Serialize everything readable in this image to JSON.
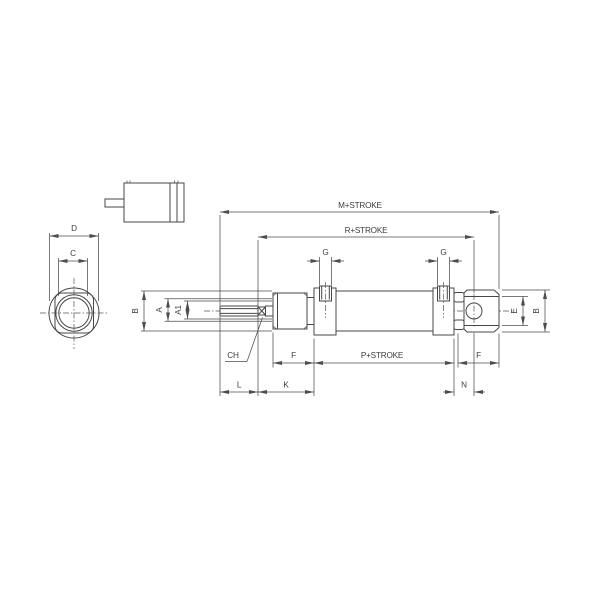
{
  "meta": {
    "type": "technical-dimensional-drawing",
    "subject": "mini pneumatic cylinder with rear eye mount, three views"
  },
  "colors": {
    "background": "#ffffff",
    "line": "#474747",
    "dimension_line": "#4d4d4d",
    "text": "#3d3d3d"
  },
  "front_view": {
    "d_label": "D",
    "c_label": "C"
  },
  "side_view": {
    "top_dims": {
      "m": "M+STROKE",
      "r": "R+STROKE"
    },
    "port_dims": {
      "g_front": "G",
      "g_rear": "G"
    },
    "left_dims": {
      "b": "B",
      "a": "A",
      "a1": "A1"
    },
    "rod_flat": {
      "ch": "CH"
    },
    "bottom_dims_row1": {
      "f_left": "F",
      "p": "P+STROKE",
      "f_right": "F"
    },
    "bottom_dims_row2": {
      "l": "L",
      "k": "K",
      "n": "N"
    },
    "right_dims": {
      "e": "E",
      "b": "B"
    }
  }
}
